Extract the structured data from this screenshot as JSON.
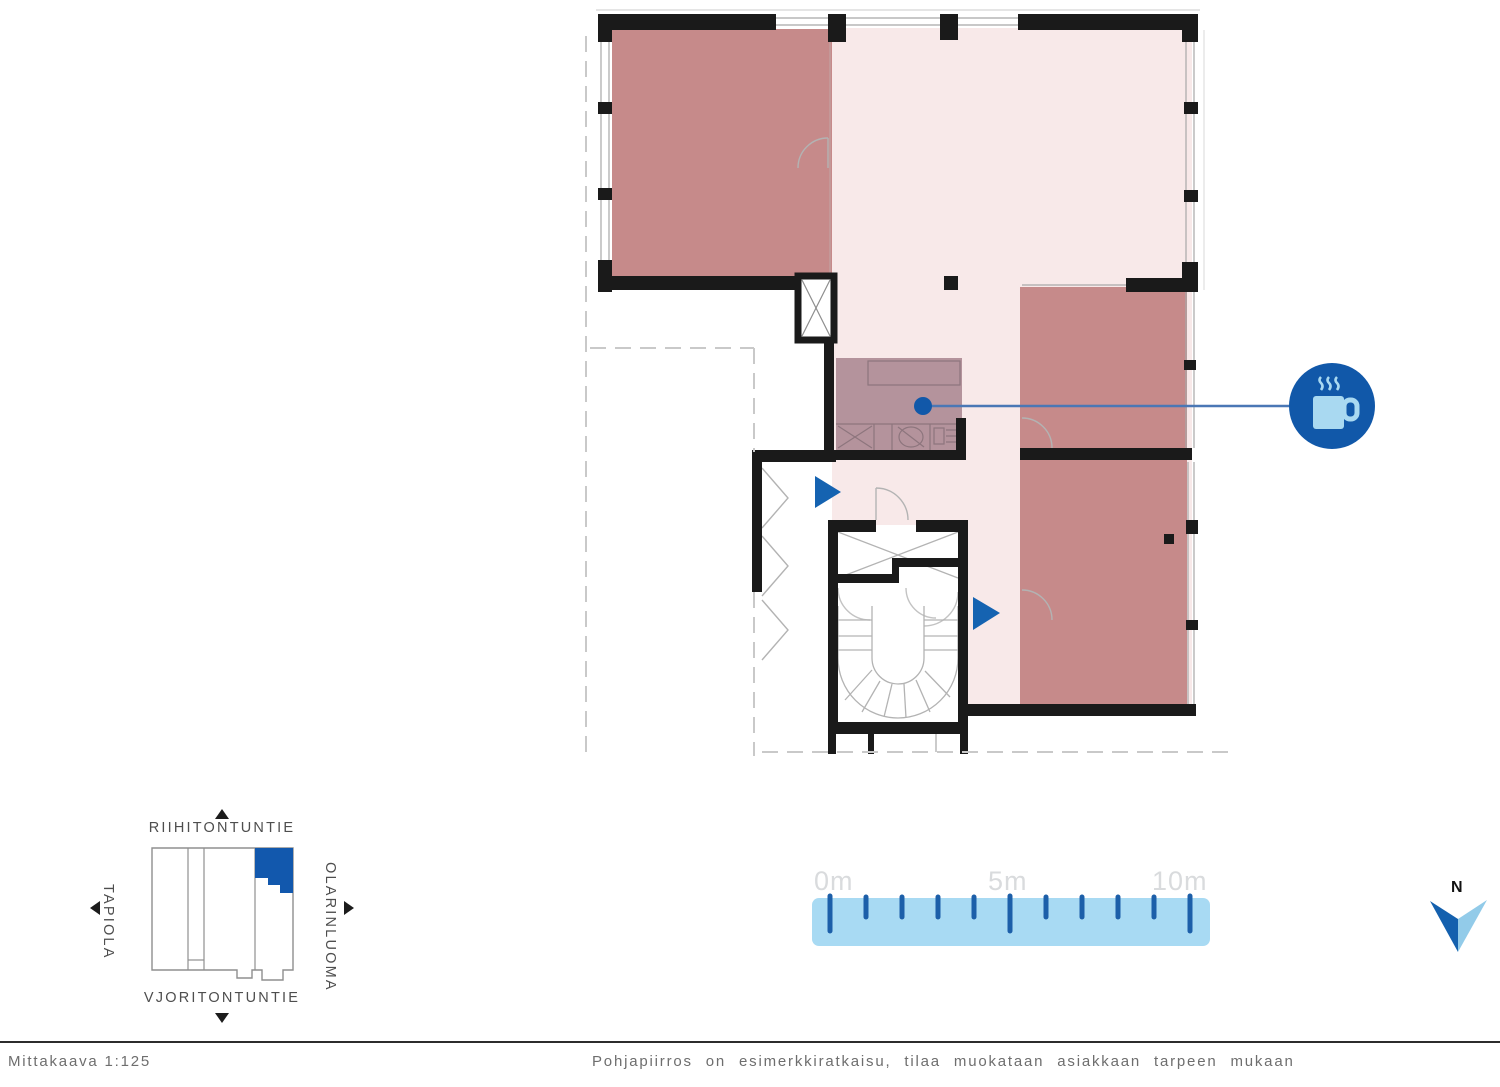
{
  "plan": {
    "hotspot_icon": "coffee-cup-icon",
    "entrance_marker_icon": "entrance-arrow-icon"
  },
  "locator": {
    "street_top": "RIIHITONTUNTIE",
    "street_bottom": "VJORITONTUNTIE",
    "street_left": "TAPIOLA",
    "street_right": "OLARINLUOMA"
  },
  "scale_bar": {
    "labels": [
      "0m",
      "5m",
      "10m"
    ]
  },
  "compass": {
    "label": "N"
  },
  "footer": {
    "scale_text": "Mittakaava 1:125",
    "disclaimer": "Pohjapiirros on esimerkkiratkaisu, tilaa muokataan asiakkaan tarpeen mukaan"
  },
  "colors": {
    "room_highlight": "#c68a8a",
    "floor_light": "#f8e9e9",
    "kitchen_overlay": "#b4939c",
    "accent_blue": "#1258ad",
    "scale_bar_fill": "#a8daf3",
    "wall": "#1a1a1a"
  }
}
